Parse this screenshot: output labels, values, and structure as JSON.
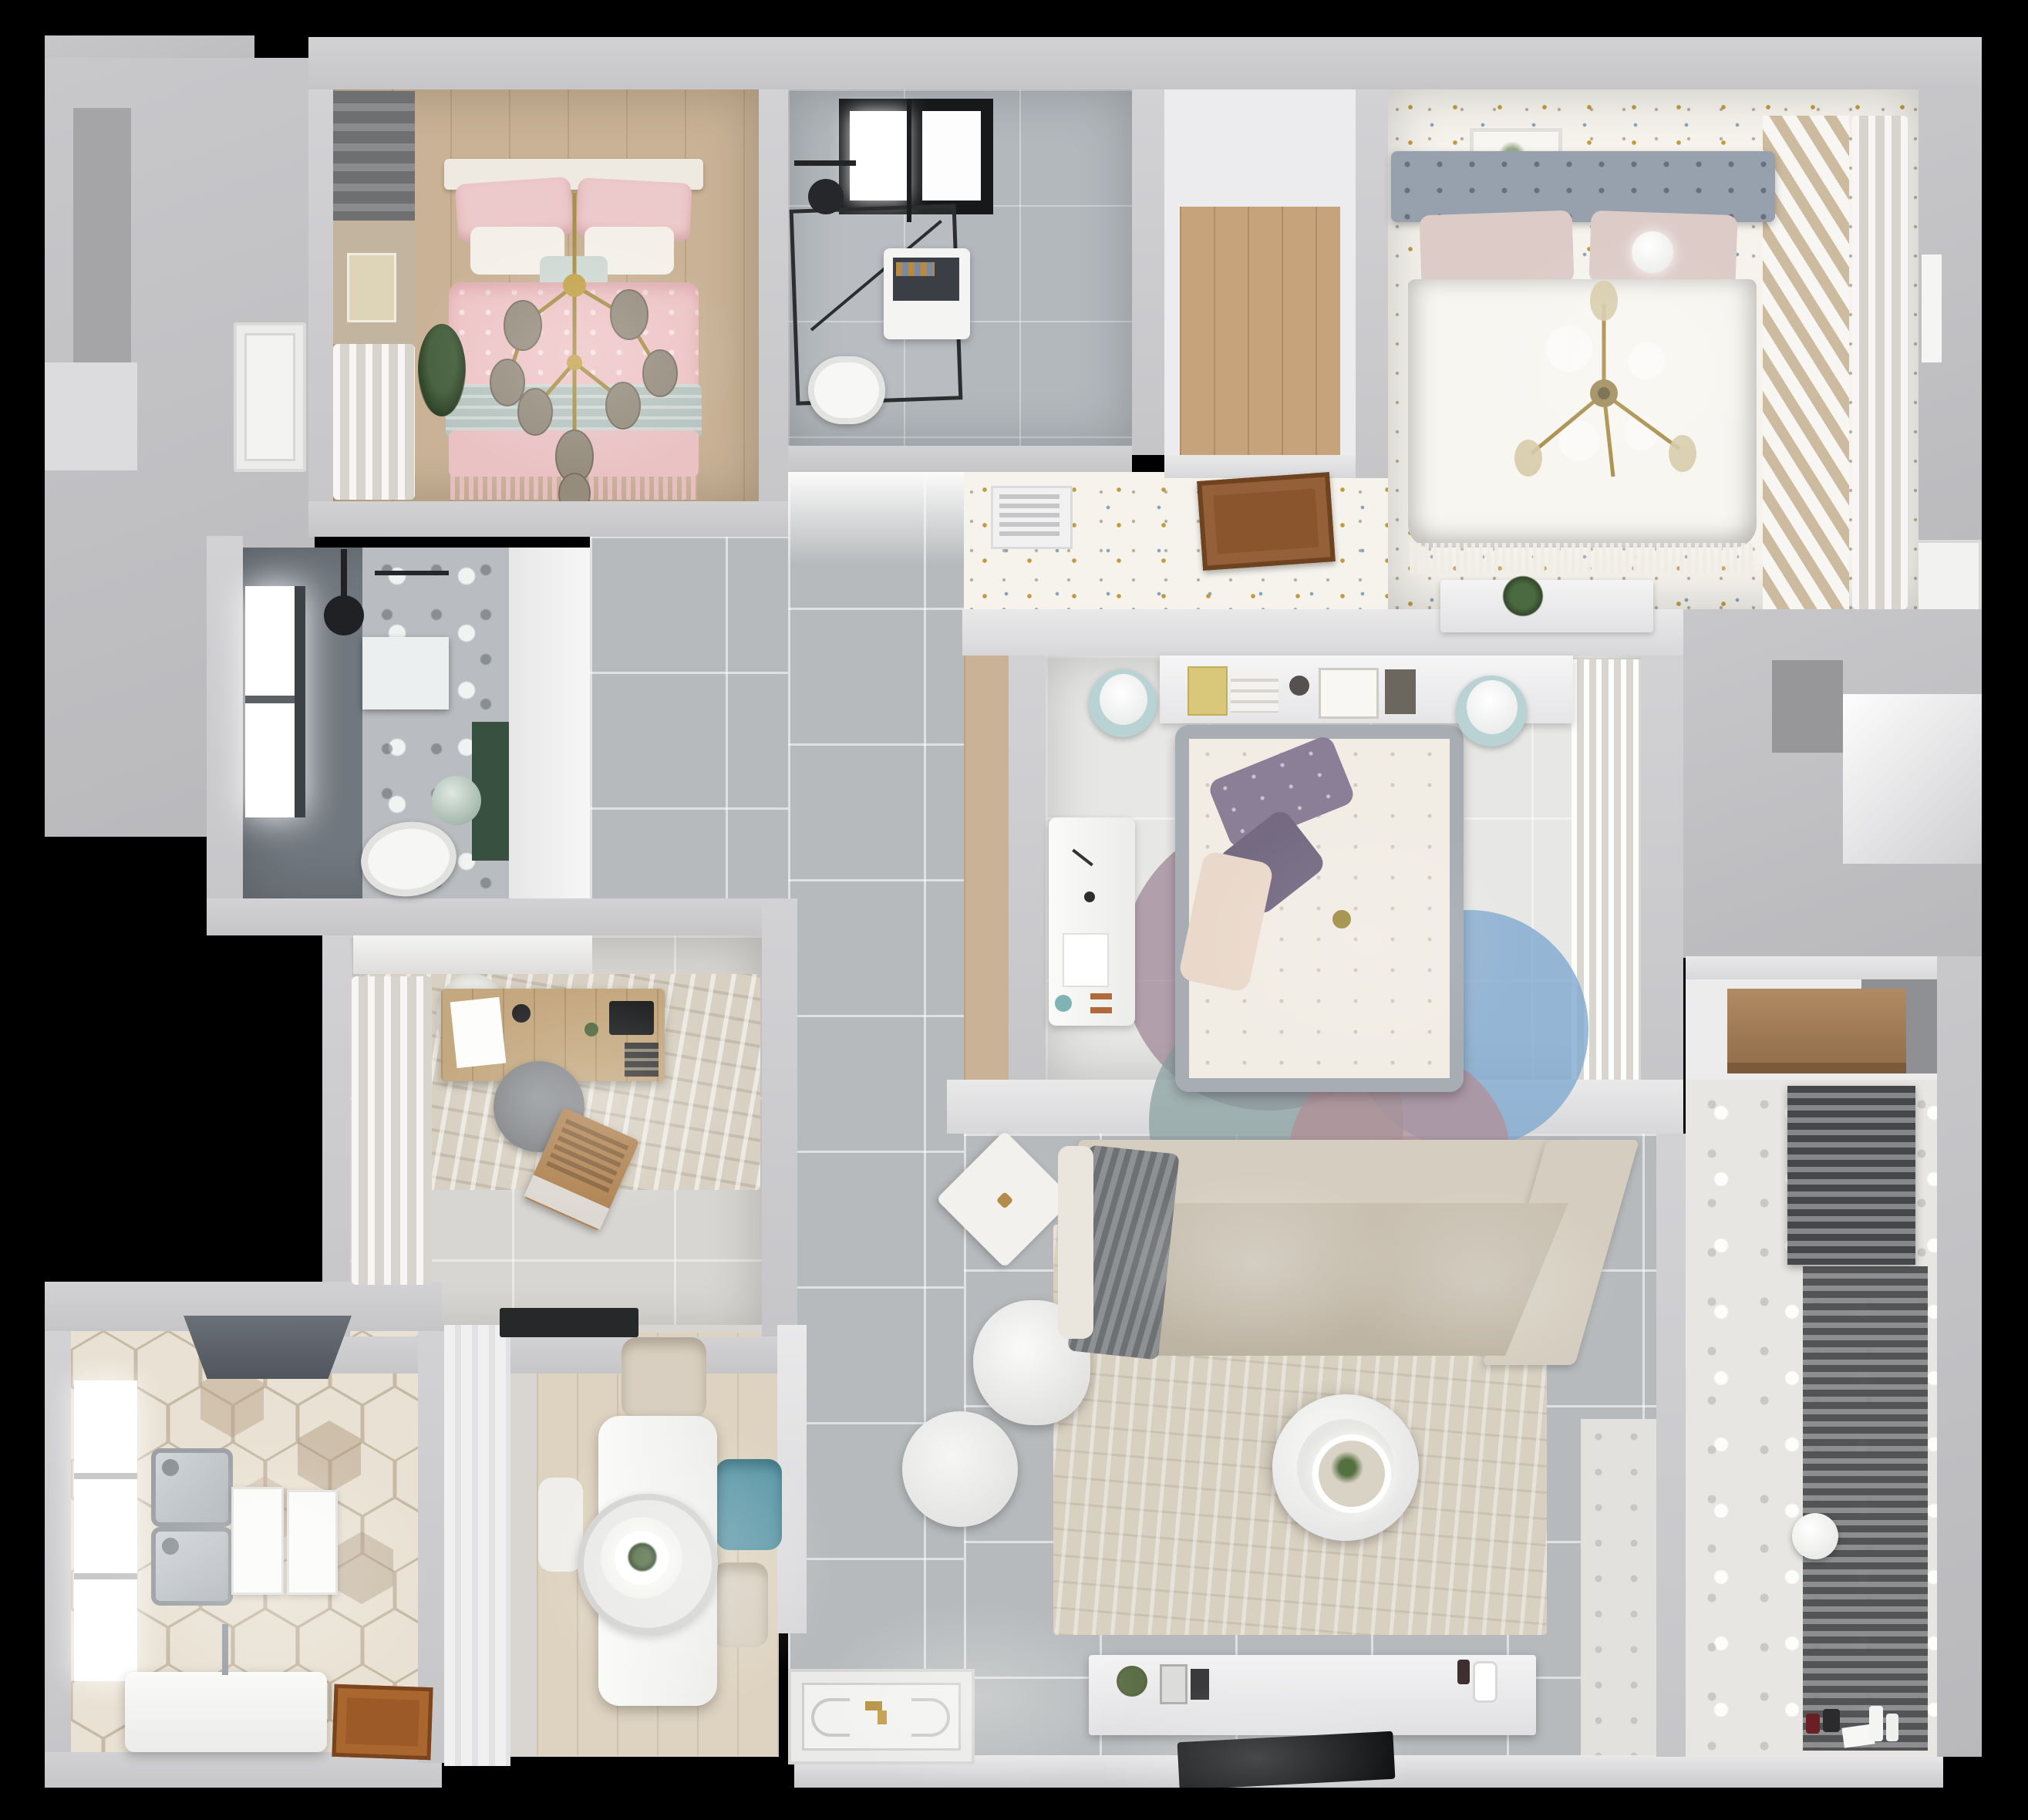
{
  "scene": {
    "label": "3D top-down dollhouse render of an apartment floor plan",
    "type": "3d-floorplan-render",
    "view": "top-down",
    "background_color": "#000000",
    "palette": {
      "outer_wall": "#c8c8cb",
      "inner_wall": "#e2e2e4",
      "hall_tile": "#b7babc",
      "wood_floor": "#c9b295",
      "closet_wood": "#c6a37a",
      "confetti_floor": "#f5f3ec",
      "confetti_gold": "#c49a3f",
      "confetti_blue": "#8aa3ba",
      "pink_bedding": "#eec4c6",
      "mint_blanket": "#b7c4c0",
      "master_headboard": "#97a0ad",
      "kids_pillow_purple": "#8b7f97",
      "sofa_beige": "#d5cdbf",
      "rug_beige": "#d8d0c1",
      "teal_chair": "#5e99a8",
      "gold_chandelier": "#a88f4a",
      "dark_rack": "#46474a",
      "plant_green": "#47603e",
      "kitchen_hex_tile": "#e9e1d3",
      "door_wood": "#8a552c"
    },
    "rooms": [
      {
        "id": "bedroom-pink",
        "label": "Bedroom with pink bedding",
        "floor": "light wood planks",
        "furniture": [
          "double bed with pink patterned duvet",
          "white and mint pillows",
          "gold sputnik chandelier with smoked-glass bulbs",
          "three botanical wall art frames",
          "dark roman blind",
          "sheer curtains",
          "floor plant"
        ]
      },
      {
        "id": "bathroom-laundry",
        "label": "Bathroom with laundry",
        "floor": "gray marble tile",
        "furniture": [
          "black-framed skylight",
          "walk-in shower with black frame",
          "black rain shower head",
          "washing machine",
          "wall-hung toilet"
        ]
      },
      {
        "id": "closet-corridor",
        "label": "Walk-in closet corridor",
        "floor": "oak planks",
        "furniture": []
      },
      {
        "id": "bedroom-master",
        "label": "Master bedroom",
        "floor": "confetti-dot carpet",
        "furniture": [
          "double bed with gray tufted headboard",
          "blush pillows",
          "white duvet",
          "gold branch chandelier",
          "botanical art frame",
          "slatted wardrobe front",
          "sheer curtain wall",
          "half-wall console with plant",
          "AC vent grille",
          "open wood door"
        ]
      },
      {
        "id": "bedroom-kids",
        "label": "Kids bedroom",
        "floor": "pale tile",
        "furniture": [
          "bed with gray frame and floral duvet",
          "purple and cream pillows",
          "headboard shelf with books",
          "two round mint nightstands",
          "white desk with copper pulls",
          "wardrobe with hanging clothes",
          "overlapping-circle rug in blue, mauve and teal"
        ]
      },
      {
        "id": "bathroom-shower",
        "label": "Shower bathroom",
        "floor": "dark slate tile",
        "furniture": [
          "bright window",
          "ceiling rain shower",
          "niche shelf",
          "toilet",
          "marble feature wall",
          "green accent panel",
          "round mirror"
        ]
      },
      {
        "id": "study",
        "label": "Study",
        "floor": "pale tile with area rug",
        "furniture": [
          "wood desk",
          "white sheet and tablet on desk",
          "gray office chair",
          "white side chair",
          "wood laptop on floor",
          "white curtains",
          "top cabinet",
          "black door mat"
        ]
      },
      {
        "id": "kitchen",
        "label": "Kitchen",
        "floor": "hexagon tiles",
        "furniture": [
          "dark range hood",
          "double stainless sink",
          "two white counter trays",
          "white island",
          "tall window",
          "open wood door leaf"
        ]
      },
      {
        "id": "dining",
        "label": "Dining area",
        "floor": "light wood rug",
        "furniture": [
          "white rectangular table",
          "ring pendant lamp with plant",
          "beige chair",
          "teal chair",
          "second beige chair",
          "white chair",
          "pantry cabinet strip"
        ]
      },
      {
        "id": "hallway-entry",
        "label": "Hallway and entry",
        "floor": "large gray tiles",
        "furniture": [
          "ornate doormat with gold key",
          "round white armchair"
        ]
      },
      {
        "id": "living",
        "label": "Living room",
        "floor": "large gray tiles",
        "furniture": [
          "corner sofa with angled chaise",
          "gray throw blanket",
          "white arm cushion",
          "diamond side table",
          "beige area rug",
          "round two-tier coffee table with plant",
          "white ottoman",
          "TV console with decor objects",
          "flat TV leaning at floor edge"
        ]
      },
      {
        "id": "balcony",
        "label": "Balcony laundry nook",
        "floor": "patterned cement tile",
        "furniture": [
          "slatted drying radiator",
          "tall slatted rack",
          "white ball",
          "small toys",
          "white bottles",
          "wood storage shelf"
        ]
      }
    ],
    "doors": [
      {
        "id": "door-left-exterior",
        "color": "white"
      },
      {
        "id": "door-master-open",
        "color": "wood brown"
      },
      {
        "id": "door-kitchen-open",
        "color": "wood brown"
      },
      {
        "id": "door-right-exterior",
        "color": "white"
      }
    ]
  }
}
